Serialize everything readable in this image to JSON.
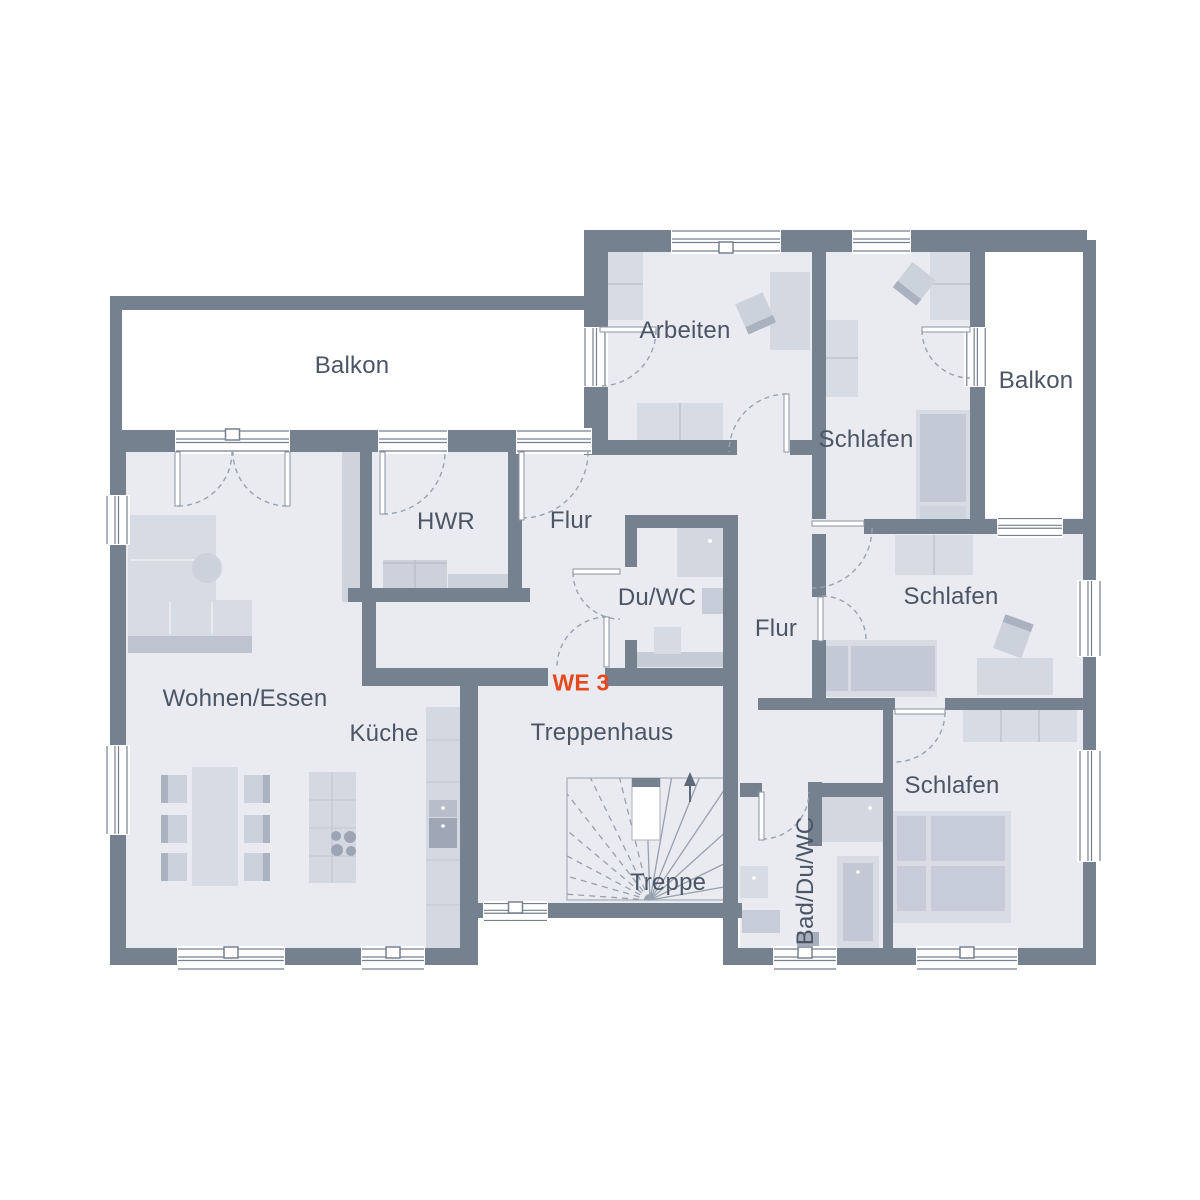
{
  "plan": {
    "type": "floor-plan",
    "unit_marker": "WE 3",
    "accent_color": "#e8481e"
  },
  "labels": {
    "balkon_left": "Balkon",
    "arbeiten": "Arbeiten",
    "schlafen_top": "Schlafen",
    "balkon_right": "Balkon",
    "hwr": "HWR",
    "flur_upper": "Flur",
    "duwc": "Du/WC",
    "flur_right": "Flur",
    "schlafen_mid": "Schlafen",
    "wohnen": "Wohnen/Essen",
    "kueche": "Küche",
    "treppenhaus": "Treppenhaus",
    "we3": "WE 3",
    "treppe": "Treppe",
    "bad": "Bad/Du/WC",
    "schlafen_bottom": "Schlafen"
  },
  "colors": {
    "wall": "#76818f",
    "floor": "#e9ebf1",
    "furniture_light": "#d7dbe3",
    "furniture_mid": "#c9cfd9",
    "furniture_dark": "#b2b9c6",
    "appliance": "#9fa7b6",
    "text": "#4b5565",
    "accent_red": "#e8481e",
    "door_arc": "#99a2af",
    "door_leaf_stroke": "#8a93a1",
    "stair_line": "#97a0ad",
    "window_line": "#76818f",
    "white": "#ffffff"
  }
}
